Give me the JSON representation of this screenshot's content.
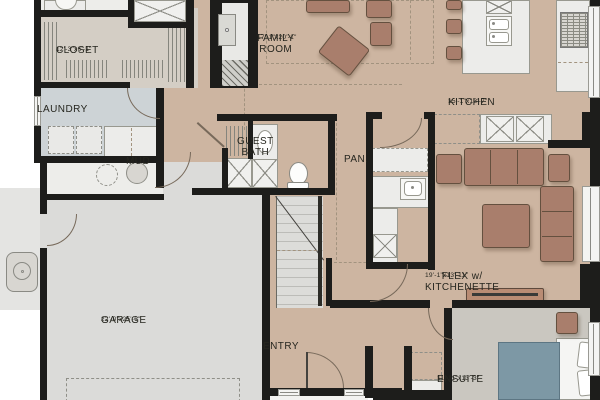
{
  "plan": {
    "type": "residential-floor-plan",
    "rooms": [
      {
        "id": "closet",
        "name": "CLOSET",
        "dims": "12'-3\"x6'-1\"",
        "cx": 116,
        "cy": 46
      },
      {
        "id": "laundry",
        "name": "LAUNDRY",
        "dims": "",
        "cx": 97,
        "cy": 105
      },
      {
        "id": "family-room",
        "name": "FAMILY\nROOM",
        "dims": "17'-1\"x20'-1\"",
        "cx": 317,
        "cy": 34
      },
      {
        "id": "kitchen",
        "name": "KITCHEN",
        "dims": "15'-1\"x13'-7\"",
        "cx": 508,
        "cy": 98
      },
      {
        "id": "mud",
        "name": "MUD",
        "dims": "",
        "cx": 186,
        "cy": 157
      },
      {
        "id": "guest-bath",
        "name": "GUEST\nBATH",
        "dims": "",
        "cx": 297,
        "cy": 137
      },
      {
        "id": "pantry",
        "name": "PAN.",
        "dims": "",
        "cx": 404,
        "cy": 155
      },
      {
        "id": "flex",
        "name": "FLEX w/\nKITCHENETTE",
        "dims": "19'-1\"x13'-11\"",
        "cx": 485,
        "cy": 272
      },
      {
        "id": "garage",
        "name": "GARAGE",
        "dims": "22'-0\"x25'-6\"",
        "cx": 161,
        "cy": 316
      },
      {
        "id": "entry",
        "name": "ENTRY",
        "dims": "",
        "cx": 323,
        "cy": 342
      },
      {
        "id": "ensuite",
        "name": "ENSUITE",
        "dims": "11'-11\"x13'-3\"",
        "cx": 497,
        "cy": 375
      }
    ],
    "colors": {
      "floor_main": "#cdb5a1",
      "floor_garage": "#dbdbd9",
      "floor_laundry": "#cdd3d6",
      "floor_closet": "#d4cec5",
      "floor_ensuite": "#cac7c0",
      "floor_mech": "#ededea",
      "outdoor_pad": "#e4e4e2",
      "wall": "#1d1d1b",
      "furniture": "#a97e6c",
      "furniture_border": "#64503f",
      "fixture": "#ececea",
      "fixture_border": "#98988f",
      "bed_blanket": "#7d98a5",
      "tv_console": "#b98c74",
      "dash": "#8f8f88",
      "rug_dash": "#a2937f"
    }
  }
}
